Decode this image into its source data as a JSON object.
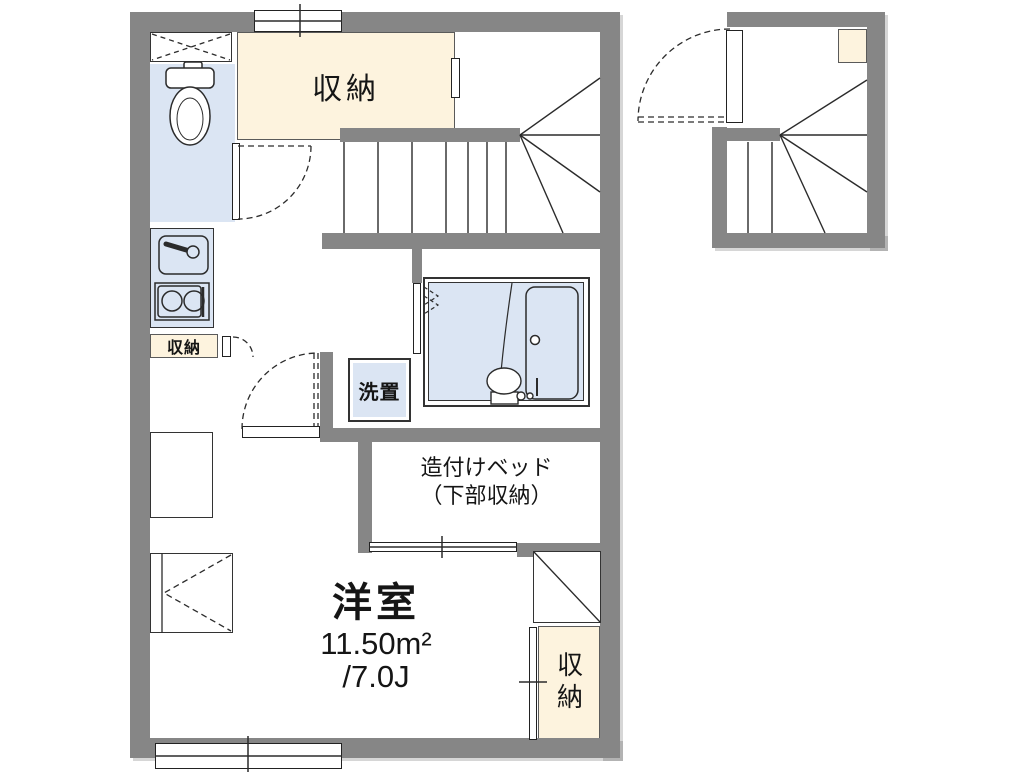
{
  "plan": {
    "rooms": {
      "storage_top": "収納",
      "storage_small": "収納",
      "washer_space": "洗置",
      "built_in_bed_line1": "造付けベッド",
      "built_in_bed_line2": "（下部収納）",
      "western_room": "洋室",
      "area_sqm": "11.50m²",
      "area_tatami": "/7.0J",
      "storage_right": "収納"
    },
    "colors": {
      "wall": "#868686",
      "storage_fill": "#fdf3de",
      "wet_area_fill": "#dbe5f3",
      "line": "#2b2b2b"
    }
  }
}
